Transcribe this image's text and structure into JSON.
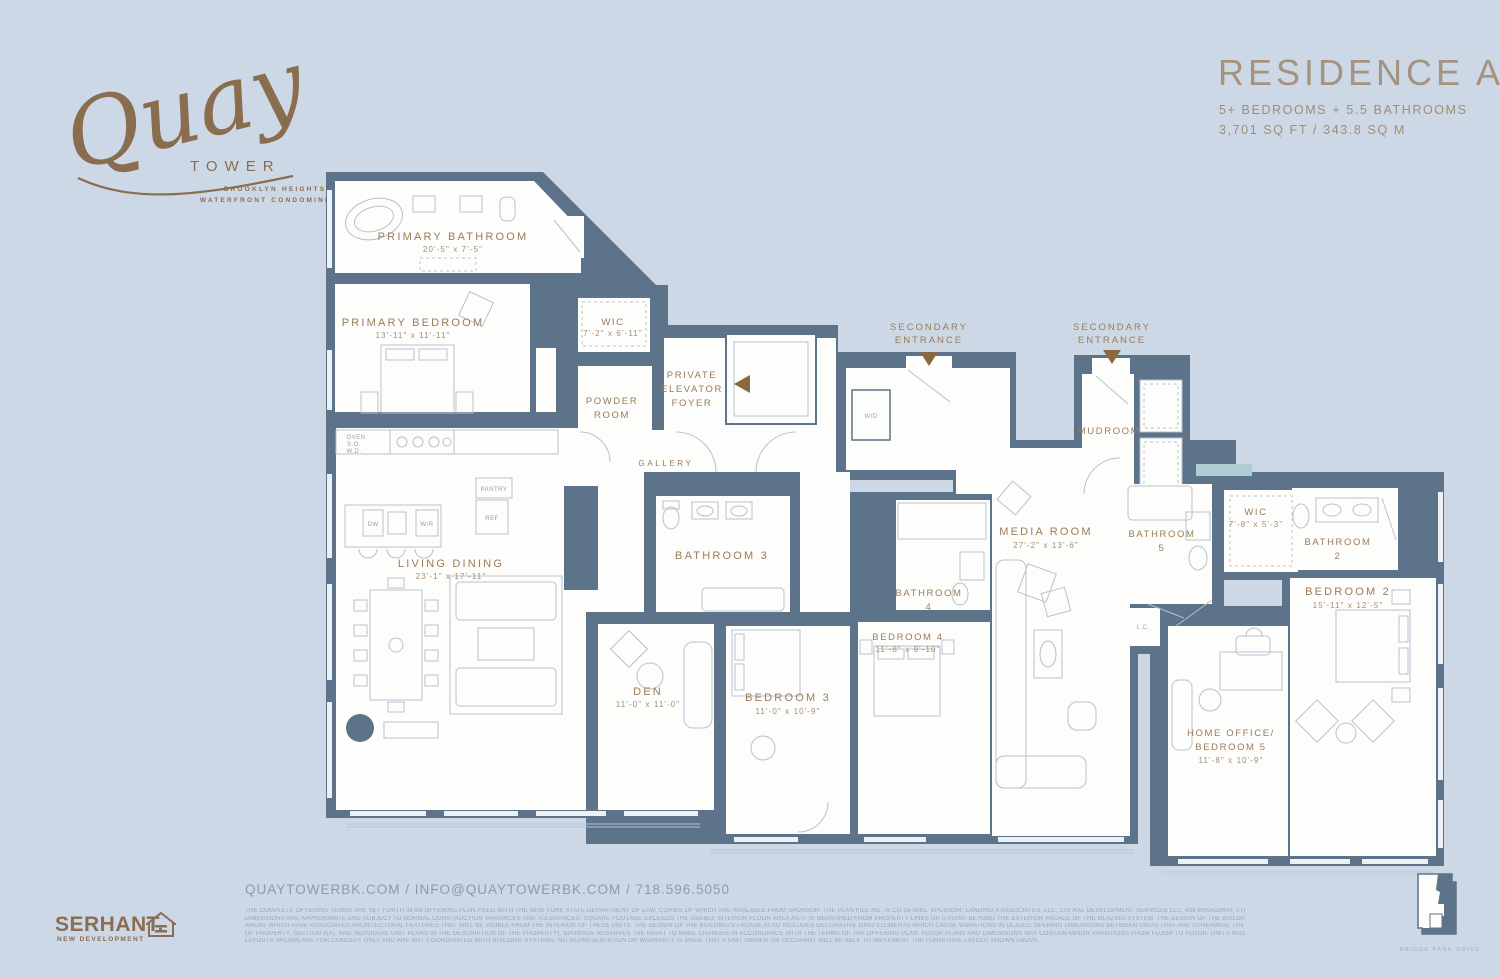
{
  "logo": {
    "script": "Quay",
    "tower": "TOWER",
    "tagline1": "BROOKLYN HEIGHTS",
    "tagline2": "WATERFRONT CONDOMINIUMS"
  },
  "header": {
    "title": "RESIDENCE A/E",
    "subtitle": "5+ BEDROOMS + 5.5 BATHROOMS",
    "area": "3,701 SQ FT / 343.8 SQ M"
  },
  "floor_plan": {
    "rooms": [
      {
        "name": "PRIMARY BATHROOM",
        "dims": "20'-5\" x 7'-5\""
      },
      {
        "name": "PRIMARY BEDROOM",
        "dims": "13'-11\" x 11'-11\""
      },
      {
        "name": "WIC",
        "dims": "7'-2\" x 6'-11\""
      },
      {
        "name": "POWDER",
        "name2": "ROOM"
      },
      {
        "name": "PRIVATE",
        "name2": "ELEVATOR",
        "name3": "FOYER"
      },
      {
        "name": "GALLERY"
      },
      {
        "name": "LIVING DINING",
        "dims": "23'-1\" x 17'-11\""
      },
      {
        "name": "DEN",
        "dims": "11'-0\" x 11'-0\""
      },
      {
        "name": "BATHROOM 3"
      },
      {
        "name": "BEDROOM 3",
        "dims": "11'-0\" x 10'-9\""
      },
      {
        "name": "BATHROOM",
        "name2": "4"
      },
      {
        "name": "BEDROOM 4",
        "dims": "11'-8\" x 9'-10\""
      },
      {
        "name": "MEDIA ROOM",
        "dims": "27'-2\" x 13'-6\""
      },
      {
        "name": "BATHROOM",
        "name2": "5"
      },
      {
        "name": "WIC",
        "dims": "7'-8\" x 5'-3\""
      },
      {
        "name": "BATHROOM",
        "name2": "2"
      },
      {
        "name": "BEDROOM 2",
        "dims": "15'-11\" x 12'-5\""
      },
      {
        "name": "HOME OFFICE/",
        "name2": "BEDROOM 5",
        "dims": "11'-8\" x 10'-9\""
      },
      {
        "name": "MUDROOM"
      }
    ],
    "entrance": {
      "line1": "SECONDARY",
      "line2": "ENTRANCE"
    },
    "fixtures": {
      "wd": "W/D",
      "lc": "L.C.",
      "pantry": "PANTRY",
      "ref": "REF",
      "dw": "DW",
      "wr": "W/R",
      "oven1": "OVEN",
      "oven2": "S.O.",
      "oven3": "W.D."
    }
  },
  "footer": {
    "contact": "QUAYTOWERBK.COM / INFO@QUAYTOWERBK.COM / 718.596.5050",
    "brand": "SERHANT.",
    "brand_sub": "NEW DEVELOPMENT",
    "keyplan_caption": "BRIDGE PARK DRIVE",
    "disclaimer_lines": [
      "THE COMPLETE OFFERING TERMS ARE SET FORTH IN AN OFFERING PLAN FILED WITH THE NEW YORK STATE DEPARTMENT OF LAW, COPIES OF WHICH ARE AVAILABLE FROM SPONSOR. THE PLAN FILE NO. IS CD 18-0061. SPONSOR: LANDING A ASSOCIATES, LLC, C/O RAL DEVELOPMENT SERVICES LLC, 434 BROADWAY, 5TH FLOOR, NEW YORK, NEW YORK, NY 10013. ALL",
      "DIMENSIONS ARE APPROXIMATE AND SUBJECT TO NORMAL CONSTRUCTION VARIANCES AND TOLERANCES. SQUARE FOOTAGE EXCEEDS THE USABLE INTERIOR FLOOR AREA AS IT IS MEASURED FROM PROPERTY LINES OR A POINT BEYOND THE EXTERIOR FACADE OF THE GLAZING SYSTEM. THE DESIGN OF THE BUILDING'S FACADE INCLUDES RANDOMIZED RECESSED",
      "AREAS WHICH HAVE ASSOCIATED ARCHITECTURAL FEATURES THAT WILL BE VISIBLE FROM THE INTERIOR OF THESE UNITS. THE DESIGN OF THE BUILDING'S FACADE ALSO INCLUDES DECORATIVE GRID ELEMENTS WHICH CAUSE VARIATIONS IN GLAZED OPENING DIMENSIONS BETWEEN UNITS THAT ARE OTHERWISE THE SAME. (SEE OFFERING PLAN PART II, DESCRIPTION",
      "OF PROPERTY, SECTION 9(A), AND INDIVIDUAL UNIT PLANS IN THE DESCRIPTION OF THE PROPERTY). SPONSOR RESERVES THE RIGHT TO MAKE CHANGES IN ACCORDANCE WITH THE TERMS OF THE OFFERING PLAN. FLOOR PLANS AND DIMENSIONS MAY CONTAIN MINOR VARIATIONS FROM FLOOR TO FLOOR. UNITS WILL NOT BE OFFERED FURNISHED. FURNITURE",
      "LAYOUTS SHOWN ARE FOR CONCEPT ONLY AND ARE NOT COORDINATED WITH BUILDING SYSTEMS. NO REPRESENTATION OR WARRANTY IS MADE THAT A UNIT OWNER OR OCCUPANT WILL BE ABLE TO IMPLEMENT THE FURNITURE LAYOUT SHOWN ABOVE."
    ]
  },
  "colors": {
    "background": "#ccd8e6",
    "walls": "#5d7389",
    "room_fill": "#fdfdfc",
    "bronze": "#9c7b58",
    "logo_bronze": "#8a6d4e",
    "line": "#b6c2cf",
    "footer_text": "#8f9aa7",
    "teal_accent": "#accdd4"
  }
}
